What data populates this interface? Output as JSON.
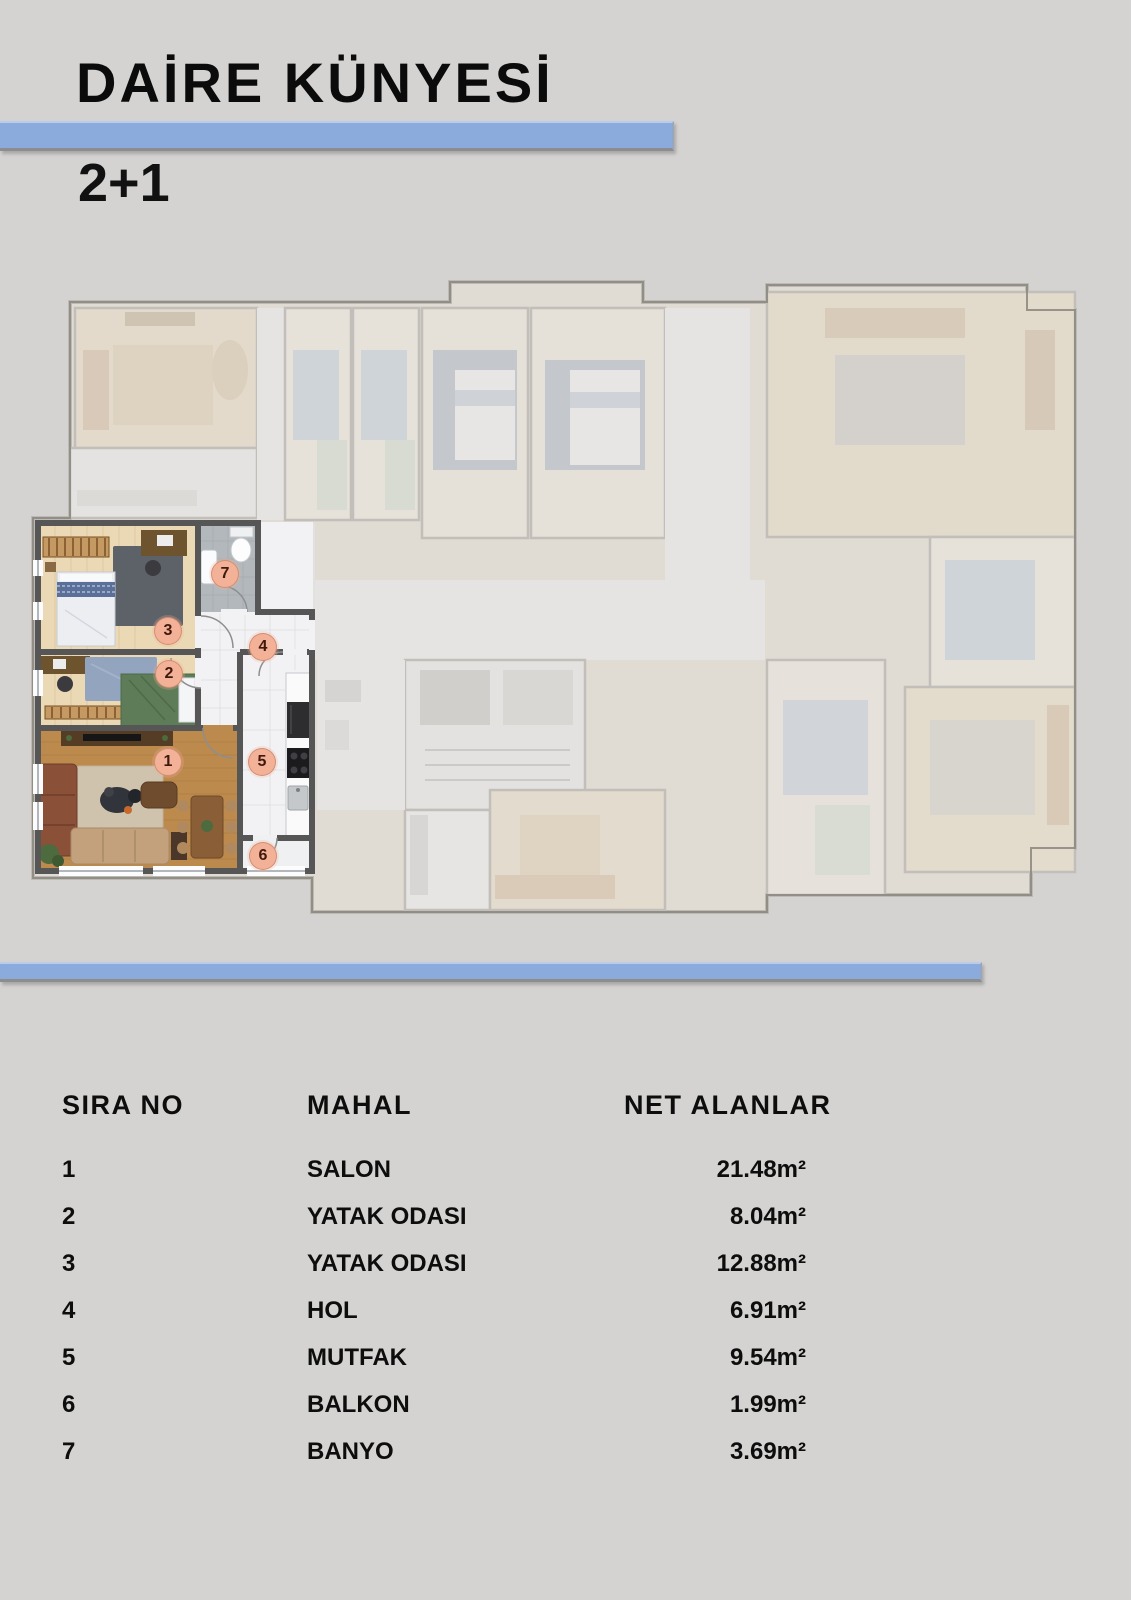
{
  "page": {
    "background": "#d4d3d1",
    "accent_color": "#8cabdd"
  },
  "header": {
    "title": "DAİRE KÜNYESİ",
    "subtitle": "2+1"
  },
  "floor_plan": {
    "description": "Building floor plan with highlighted 2+1 apartment at lower left",
    "markers": [
      "1",
      "2",
      "3",
      "4",
      "5",
      "6",
      "7"
    ]
  },
  "table": {
    "headers": [
      "SIRA NO",
      "MAHAL",
      "NET ALANLAR"
    ],
    "rows": [
      {
        "no": "1",
        "mahal": "SALON",
        "net_alan": "21.48m²"
      },
      {
        "no": "2",
        "mahal": "YATAK ODASI",
        "net_alan": "8.04m²"
      },
      {
        "no": "3",
        "mahal": "YATAK ODASI",
        "net_alan": "12.88m²"
      },
      {
        "no": "4",
        "mahal": "HOL",
        "net_alan": "6.91m²"
      },
      {
        "no": "5",
        "mahal": "MUTFAK",
        "net_alan": "9.54m²"
      },
      {
        "no": "6",
        "mahal": "BALKON",
        "net_alan": "1.99m²"
      },
      {
        "no": "7",
        "mahal": "BANYO",
        "net_alan": "3.69m²"
      }
    ]
  }
}
